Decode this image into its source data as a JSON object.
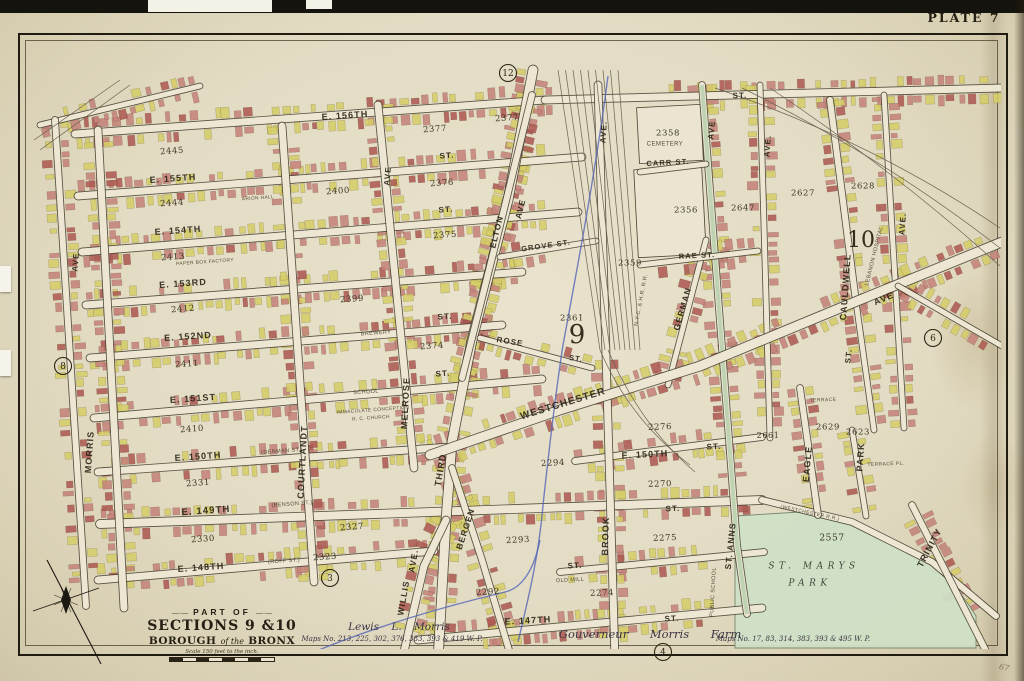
{
  "plate_label": "PLATE 7",
  "page_mark": "67",
  "title_block": {
    "part_of": "PART OF",
    "sections": "SECTIONS 9 &10",
    "borough_left": "BOROUGH",
    "borough_mid": "of the",
    "borough_right": "BRONX",
    "scale_note": "Scale 150 feet to the inch."
  },
  "footer": {
    "surveyor": "Lewis L. Morris",
    "maps_left": "Maps No. 213, 225, 302, 376, 383, 393 & 419 W. P.",
    "farm": "Gouverneur Morris Farm",
    "maps_right": "Maps No. 17, 83, 314, 383, 393 & 495 W. P."
  },
  "colors": {
    "paper": "#e7e0ca",
    "road_fill": "#ece6d2",
    "road_edge": "#3f382a",
    "building_pink": "#c5837a",
    "building_red": "#ad5a52",
    "building_yellow": "#d5cd68",
    "park_green": "#cfe0c6",
    "avenue_green": "#b7cfad",
    "brook_blue": "#5567b8",
    "ink": "#2b2518"
  },
  "map": {
    "labels": [
      {
        "t": "E. 156TH",
        "x": 345,
        "y": 116,
        "r": -4,
        "s": 9,
        "k": "street"
      },
      {
        "t": "E. 155TH",
        "x": 173,
        "y": 179,
        "r": -4,
        "s": 9,
        "k": "street"
      },
      {
        "t": "E. 154TH",
        "x": 178,
        "y": 231,
        "r": -4,
        "s": 9,
        "k": "street"
      },
      {
        "t": "E. 153RD",
        "x": 183,
        "y": 284,
        "r": -4,
        "s": 9,
        "k": "street"
      },
      {
        "t": "E. 152ND",
        "x": 188,
        "y": 337,
        "r": -4,
        "s": 9,
        "k": "street"
      },
      {
        "t": "E. 151ST",
        "x": 193,
        "y": 399,
        "r": -4,
        "s": 9,
        "k": "street"
      },
      {
        "t": "E. 150TH",
        "x": 198,
        "y": 457,
        "r": -4,
        "s": 9,
        "k": "street"
      },
      {
        "t": "(DENMAN ST.)",
        "x": 282,
        "y": 451,
        "r": -4,
        "s": 5.5,
        "k": "tiny"
      },
      {
        "t": "E. 149TH",
        "x": 206,
        "y": 511,
        "r": -4,
        "s": 9.5,
        "k": "street"
      },
      {
        "t": "(BENSON ST.)",
        "x": 292,
        "y": 504,
        "r": -4,
        "s": 5.5,
        "k": "tiny"
      },
      {
        "t": "E. 148TH",
        "x": 201,
        "y": 568,
        "r": -4,
        "s": 9,
        "k": "street"
      },
      {
        "t": "(ROFF ST.)",
        "x": 284,
        "y": 561,
        "r": -4,
        "s": 5.5,
        "k": "tiny"
      },
      {
        "t": "E. 147TH",
        "x": 528,
        "y": 621,
        "r": -3,
        "s": 9,
        "k": "street"
      },
      {
        "t": "E. 150TH",
        "x": 645,
        "y": 455,
        "r": -3,
        "s": 9,
        "k": "street"
      },
      {
        "t": "ST.",
        "x": 714,
        "y": 447,
        "r": -3,
        "s": 8,
        "k": "street"
      },
      {
        "t": "ST.",
        "x": 447,
        "y": 156,
        "r": -4,
        "s": 8,
        "k": "street"
      },
      {
        "t": "ST.",
        "x": 446,
        "y": 210,
        "r": -4,
        "s": 8,
        "k": "street"
      },
      {
        "t": "ST.",
        "x": 445,
        "y": 317,
        "r": -4,
        "s": 8,
        "k": "street"
      },
      {
        "t": "ST.",
        "x": 443,
        "y": 374,
        "r": -4,
        "s": 8,
        "k": "street"
      },
      {
        "t": "ST.",
        "x": 673,
        "y": 509,
        "r": -2,
        "s": 8,
        "k": "street"
      },
      {
        "t": "ST.",
        "x": 575,
        "y": 566,
        "r": -3,
        "s": 8,
        "k": "street"
      },
      {
        "t": "ST.",
        "x": 672,
        "y": 619,
        "r": -3,
        "s": 8,
        "k": "street"
      },
      {
        "t": "ST.",
        "x": 740,
        "y": 96,
        "r": -1,
        "s": 8,
        "k": "street"
      },
      {
        "t": "CARR  ST.",
        "x": 668,
        "y": 163,
        "r": -3,
        "s": 7.5,
        "k": "street"
      },
      {
        "t": "RAE  ST.",
        "x": 697,
        "y": 256,
        "r": -3,
        "s": 7.5,
        "k": "street"
      },
      {
        "t": "GROVE  ST.",
        "x": 546,
        "y": 246,
        "r": -8,
        "s": 7.5,
        "k": "street"
      },
      {
        "t": "ROSE",
        "x": 510,
        "y": 342,
        "r": 9,
        "s": 8,
        "k": "street"
      },
      {
        "t": "ST.",
        "x": 576,
        "y": 359,
        "r": 9,
        "s": 7.5,
        "k": "street"
      },
      {
        "t": "WESTCHESTER",
        "x": 563,
        "y": 404,
        "r": -17,
        "s": 10,
        "k": "ave",
        "ls": 2.5
      },
      {
        "t": "AVE",
        "x": 884,
        "y": 299,
        "r": -23,
        "s": 9,
        "k": "ave"
      },
      {
        "t": "MORRIS",
        "x": 90,
        "y": 452,
        "r": -86,
        "s": 9,
        "k": "ave"
      },
      {
        "t": "AVE",
        "x": 76,
        "y": 262,
        "r": -86,
        "s": 8,
        "k": "ave"
      },
      {
        "t": "COURTLANDT",
        "x": 303,
        "y": 462,
        "r": -87,
        "s": 9,
        "k": "ave"
      },
      {
        "t": "MELROSE",
        "x": 406,
        "y": 403,
        "r": -87,
        "s": 9,
        "k": "ave"
      },
      {
        "t": "AVE",
        "x": 388,
        "y": 176,
        "r": -85,
        "s": 8,
        "k": "ave"
      },
      {
        "t": "ELTON",
        "x": 497,
        "y": 232,
        "r": -76,
        "s": 8.5,
        "k": "ave"
      },
      {
        "t": "AVE",
        "x": 521,
        "y": 209,
        "r": -76,
        "s": 8.5,
        "k": "ave"
      },
      {
        "t": "THIRD",
        "x": 441,
        "y": 470,
        "r": -80,
        "s": 9,
        "k": "ave"
      },
      {
        "t": "WILLIS",
        "x": 404,
        "y": 598,
        "r": -80,
        "s": 8.5,
        "k": "ave"
      },
      {
        "t": "AVE.",
        "x": 414,
        "y": 561,
        "r": -80,
        "s": 8.5,
        "k": "ave"
      },
      {
        "t": "BERGEN",
        "x": 466,
        "y": 529,
        "r": -72,
        "s": 8.5,
        "k": "ave"
      },
      {
        "t": "BROOK",
        "x": 606,
        "y": 536,
        "r": -88,
        "s": 9,
        "k": "ave"
      },
      {
        "t": "ST. ANNS",
        "x": 731,
        "y": 546,
        "r": -84,
        "s": 8.5,
        "k": "ave"
      },
      {
        "t": "GERMAN",
        "x": 683,
        "y": 309,
        "r": -74,
        "s": 8.5,
        "k": "ave"
      },
      {
        "t": "EAGLE",
        "x": 808,
        "y": 464,
        "r": -85,
        "s": 9,
        "k": "ave"
      },
      {
        "t": "PARK",
        "x": 861,
        "y": 457,
        "r": -86,
        "s": 9,
        "k": "ave"
      },
      {
        "t": "CAULDWELL",
        "x": 846,
        "y": 287,
        "r": -86,
        "s": 9,
        "k": "ave"
      },
      {
        "t": "ST.",
        "x": 849,
        "y": 356,
        "r": -84,
        "s": 8,
        "k": "ave"
      },
      {
        "t": "AVE.",
        "x": 903,
        "y": 224,
        "r": -86,
        "s": 8,
        "k": "ave"
      },
      {
        "t": "TRINITY",
        "x": 930,
        "y": 548,
        "r": -62,
        "s": 9,
        "k": "ave"
      },
      {
        "t": "AVE.",
        "x": 768,
        "y": 146,
        "r": -86,
        "s": 8,
        "k": "ave"
      },
      {
        "t": "AVE",
        "x": 712,
        "y": 130,
        "r": -84,
        "s": 8,
        "k": "ave"
      },
      {
        "t": "AVE.",
        "x": 604,
        "y": 132,
        "r": -86,
        "s": 8,
        "k": "ave"
      },
      {
        "t": "2445",
        "x": 172,
        "y": 151,
        "r": -4,
        "s": 8.5,
        "k": "num"
      },
      {
        "t": "2444",
        "x": 172,
        "y": 203,
        "r": -4,
        "s": 8.5,
        "k": "num"
      },
      {
        "t": "2413",
        "x": 173,
        "y": 257,
        "r": -4,
        "s": 8.5,
        "k": "num"
      },
      {
        "t": "2412",
        "x": 183,
        "y": 309,
        "r": -4,
        "s": 8.5,
        "k": "num"
      },
      {
        "t": "2411",
        "x": 187,
        "y": 364,
        "r": -4,
        "s": 8.5,
        "k": "num"
      },
      {
        "t": "2410",
        "x": 192,
        "y": 429,
        "r": -4,
        "s": 8.5,
        "k": "num"
      },
      {
        "t": "2331",
        "x": 198,
        "y": 483,
        "r": -4,
        "s": 8.5,
        "k": "num"
      },
      {
        "t": "2330",
        "x": 203,
        "y": 539,
        "r": -4,
        "s": 8.5,
        "k": "num"
      },
      {
        "t": "2400",
        "x": 338,
        "y": 191,
        "r": -4,
        "s": 8.5,
        "k": "num"
      },
      {
        "t": "2399",
        "x": 352,
        "y": 299,
        "r": -4,
        "s": 8.5,
        "k": "num"
      },
      {
        "t": "2377",
        "x": 435,
        "y": 129,
        "r": -4,
        "s": 8.5,
        "k": "num"
      },
      {
        "t": "2377",
        "x": 507,
        "y": 118,
        "r": -4,
        "s": 8.5,
        "k": "num"
      },
      {
        "t": "2376",
        "x": 442,
        "y": 183,
        "r": -4,
        "s": 8.5,
        "k": "num"
      },
      {
        "t": "2375",
        "x": 445,
        "y": 235,
        "r": -4,
        "s": 8.5,
        "k": "num"
      },
      {
        "t": "2374",
        "x": 432,
        "y": 346,
        "r": -4,
        "s": 8.5,
        "k": "num"
      },
      {
        "t": "2361",
        "x": 572,
        "y": 318,
        "r": 0,
        "s": 8.5,
        "k": "num"
      },
      {
        "t": "2358",
        "x": 668,
        "y": 133,
        "r": 0,
        "s": 8.5,
        "k": "num"
      },
      {
        "t": "2356",
        "x": 686,
        "y": 210,
        "r": 0,
        "s": 8.5,
        "k": "num"
      },
      {
        "t": "2359",
        "x": 630,
        "y": 263,
        "r": 0,
        "s": 8.5,
        "k": "num"
      },
      {
        "t": "2647",
        "x": 743,
        "y": 208,
        "r": 0,
        "s": 8.5,
        "k": "num"
      },
      {
        "t": "2627",
        "x": 803,
        "y": 193,
        "r": 0,
        "s": 8.5,
        "k": "num"
      },
      {
        "t": "2628",
        "x": 863,
        "y": 186,
        "r": 0,
        "s": 8.5,
        "k": "num"
      },
      {
        "t": "2629",
        "x": 828,
        "y": 427,
        "r": 0,
        "s": 8.5,
        "k": "num"
      },
      {
        "t": "2623",
        "x": 858,
        "y": 432,
        "r": 0,
        "s": 8.5,
        "k": "num"
      },
      {
        "t": "2661",
        "x": 768,
        "y": 436,
        "r": 0,
        "s": 8,
        "k": "num"
      },
      {
        "t": "2276",
        "x": 660,
        "y": 427,
        "r": -2,
        "s": 8.5,
        "k": "num"
      },
      {
        "t": "2270",
        "x": 660,
        "y": 484,
        "r": -2,
        "s": 8.5,
        "k": "num"
      },
      {
        "t": "2275",
        "x": 665,
        "y": 538,
        "r": -2,
        "s": 8.5,
        "k": "num"
      },
      {
        "t": "2274",
        "x": 602,
        "y": 593,
        "r": -2,
        "s": 8.5,
        "k": "num"
      },
      {
        "t": "2292",
        "x": 488,
        "y": 592,
        "r": -3,
        "s": 8.5,
        "k": "num"
      },
      {
        "t": "2293",
        "x": 518,
        "y": 540,
        "r": -3,
        "s": 8.5,
        "k": "num"
      },
      {
        "t": "2294",
        "x": 553,
        "y": 463,
        "r": -3,
        "s": 8.5,
        "k": "num"
      },
      {
        "t": "2327",
        "x": 352,
        "y": 527,
        "r": -4,
        "s": 8.5,
        "k": "num"
      },
      {
        "t": "2323",
        "x": 325,
        "y": 557,
        "r": -4,
        "s": 8.5,
        "k": "num"
      },
      {
        "t": "2557",
        "x": 832,
        "y": 538,
        "r": 0,
        "s": 9,
        "k": "num"
      },
      {
        "t": "CEMETERY",
        "x": 665,
        "y": 144,
        "r": 0,
        "s": 6,
        "k": "tiny"
      },
      {
        "t": "BREWERY",
        "x": 376,
        "y": 333,
        "r": -4,
        "s": 5.5,
        "k": "tiny"
      },
      {
        "t": "SCHOOL",
        "x": 366,
        "y": 392,
        "r": -4,
        "s": 5.5,
        "k": "tiny"
      },
      {
        "t": "IMMACULATE CONCEPTION",
        "x": 373,
        "y": 410,
        "r": -4,
        "s": 4.8,
        "k": "tiny"
      },
      {
        "t": "R. C. CHURCH",
        "x": 371,
        "y": 418,
        "r": -4,
        "s": 4.8,
        "k": "tiny"
      },
      {
        "t": "OLD MILL",
        "x": 570,
        "y": 580,
        "r": -3,
        "s": 5.5,
        "k": "tiny"
      },
      {
        "t": "PUBLIC SCHOOL",
        "x": 713,
        "y": 592,
        "r": -87,
        "s": 5.5,
        "k": "tiny"
      },
      {
        "t": "LEBANON HOSPITAL",
        "x": 874,
        "y": 256,
        "r": -76,
        "s": 5.5,
        "k": "tiny"
      },
      {
        "t": "PAPER BOX FACTORY",
        "x": 205,
        "y": 262,
        "r": -4,
        "s": 4.8,
        "k": "tiny"
      },
      {
        "t": "ARION HALL",
        "x": 258,
        "y": 198,
        "r": -4,
        "s": 4.8,
        "k": "tiny"
      },
      {
        "t": "TERRACE",
        "x": 823,
        "y": 400,
        "r": -2,
        "s": 5,
        "k": "tiny"
      },
      {
        "t": "TERRACE PL.",
        "x": 886,
        "y": 464,
        "r": -2,
        "s": 5,
        "k": "tiny"
      },
      {
        "t": "(WESTCHESTER R.R.)",
        "x": 810,
        "y": 513,
        "r": 12,
        "s": 5,
        "k": "tiny"
      },
      {
        "t": "N.Y.C. & H.R. R.R.",
        "x": 641,
        "y": 300,
        "r": -79,
        "s": 5.5,
        "k": "tiny"
      },
      {
        "t": "ST.  MARYS",
        "x": 814,
        "y": 566,
        "r": 0,
        "s": 9,
        "k": "park"
      },
      {
        "t": "PARK",
        "x": 810,
        "y": 583,
        "r": 0,
        "s": 9,
        "k": "park"
      },
      {
        "t": "9",
        "x": 577,
        "y": 336,
        "r": 0,
        "s": 26,
        "k": "big"
      },
      {
        "t": "10",
        "x": 861,
        "y": 241,
        "r": 0,
        "s": 22,
        "k": "big"
      },
      {
        "t": "12",
        "x": 508,
        "y": 73,
        "r": 0,
        "s": 9,
        "k": "circle"
      },
      {
        "t": "8",
        "x": 63,
        "y": 366,
        "r": 0,
        "s": 9,
        "k": "circle"
      },
      {
        "t": "6",
        "x": 933,
        "y": 338,
        "r": 0,
        "s": 9,
        "k": "circle"
      },
      {
        "t": "3",
        "x": 330,
        "y": 578,
        "r": 0,
        "s": 9,
        "k": "circle"
      },
      {
        "t": "4",
        "x": 663,
        "y": 652,
        "r": 0,
        "s": 9,
        "k": "circle"
      }
    ]
  }
}
